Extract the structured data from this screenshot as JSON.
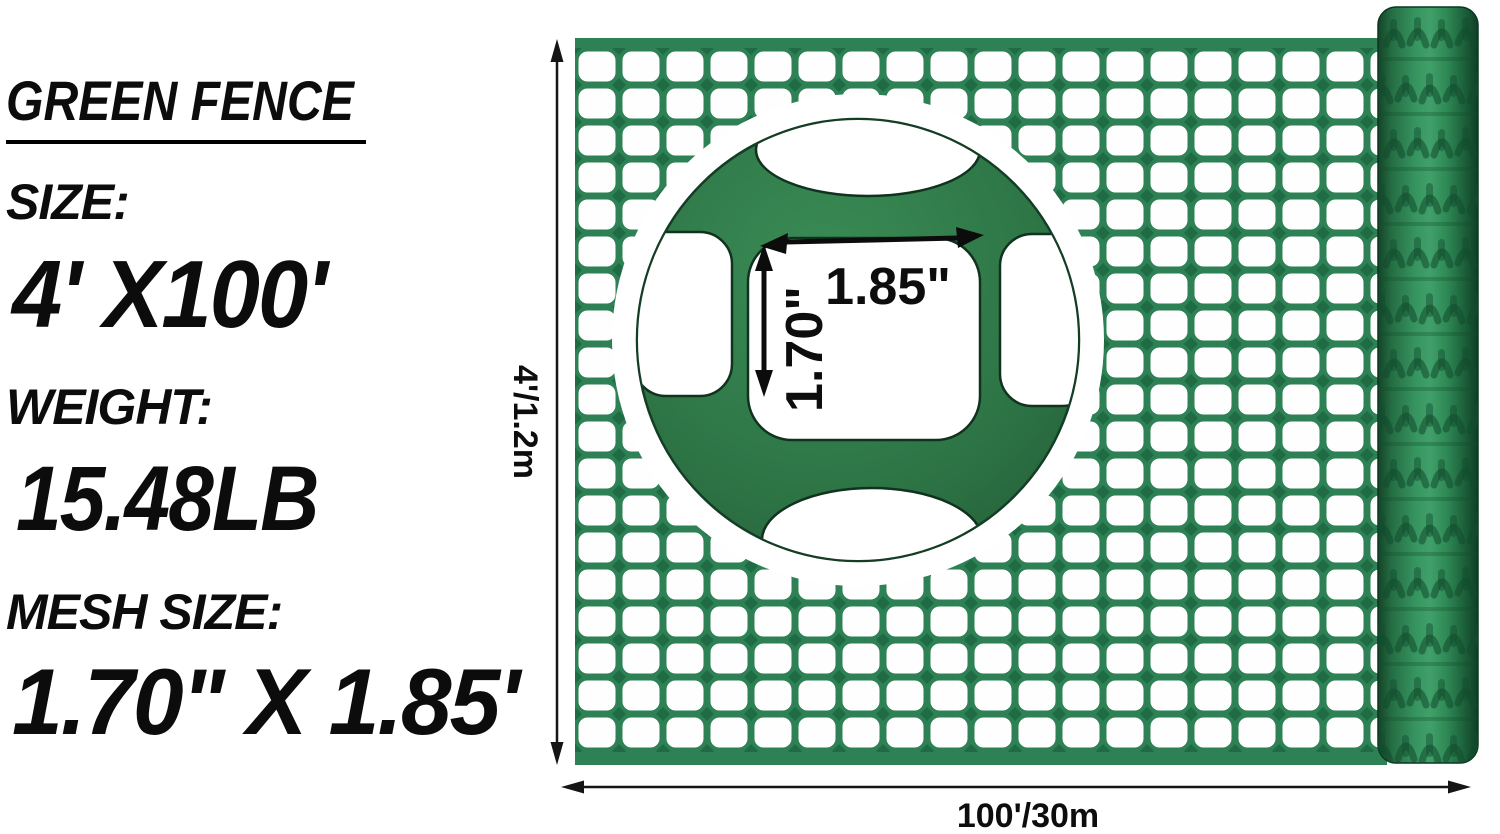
{
  "specs": {
    "title": "GREEN FENCE",
    "size_label": "SIZE:",
    "size_value": "4' X100'",
    "weight_label": "WEIGHT:",
    "weight_value": "15.48LB",
    "mesh_size_label": "MESH SIZE:",
    "mesh_size_value": "1.70\" X 1.85'"
  },
  "annotations": {
    "fence_height": "4'/1.2m",
    "fence_length": "100'/30m",
    "mesh_opening_width": "1.85\"",
    "mesh_opening_height": "1.70\""
  },
  "colors": {
    "mesh_strand_green": "#2e8155",
    "mesh_joint_green": "#1f6b44",
    "zoom_disc_green": "#2d7445",
    "roll_green": "#2f8a56",
    "annotation_black": "#0d0d0d",
    "background": "#ffffff"
  }
}
